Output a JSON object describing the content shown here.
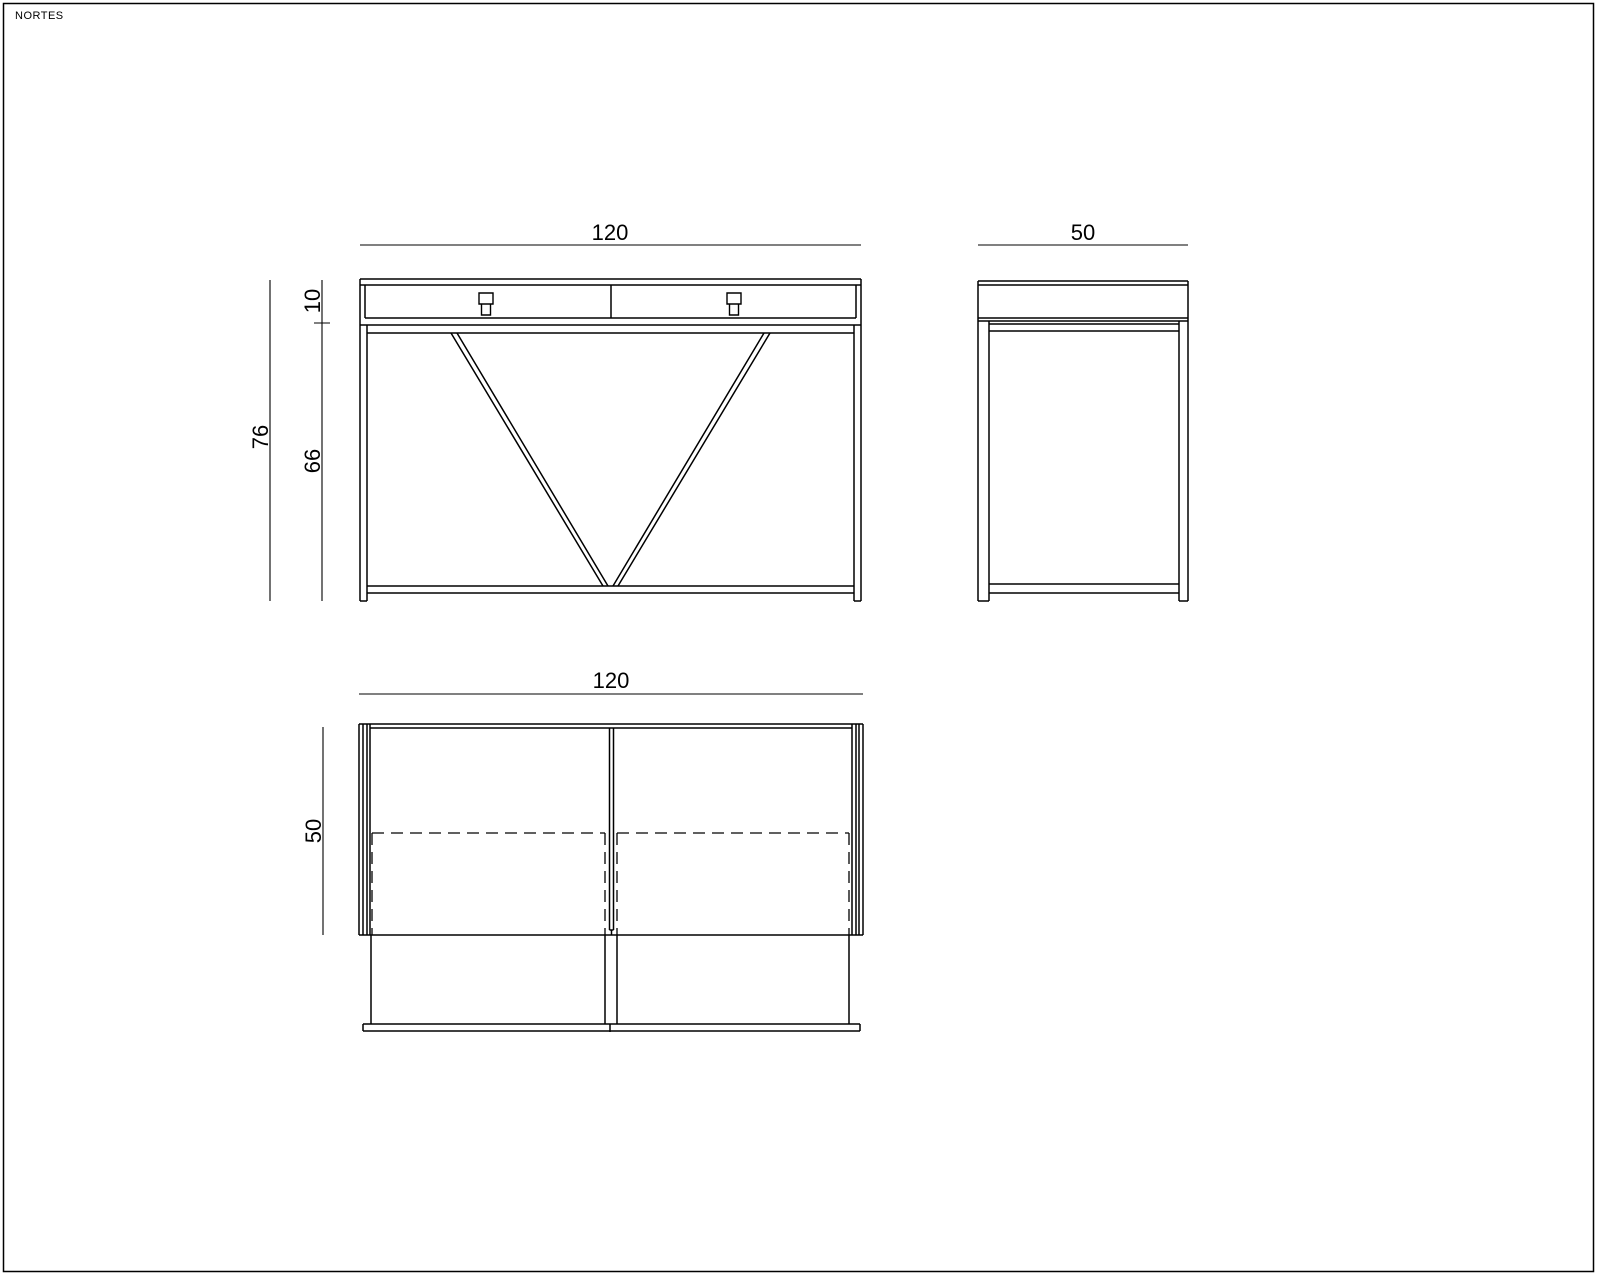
{
  "sheet": {
    "brand": "NORTES"
  },
  "colors": {
    "line": "#000000",
    "background": "#ffffff"
  },
  "views": {
    "front": {
      "name": "front elevation",
      "width": "120",
      "total_height": "76",
      "top_section_height": "10",
      "lower_section_height": "66",
      "drawer_count": 2
    },
    "side": {
      "name": "side elevation",
      "depth": "50"
    },
    "plan": {
      "name": "plan view",
      "width": "120",
      "depth": "50"
    }
  }
}
